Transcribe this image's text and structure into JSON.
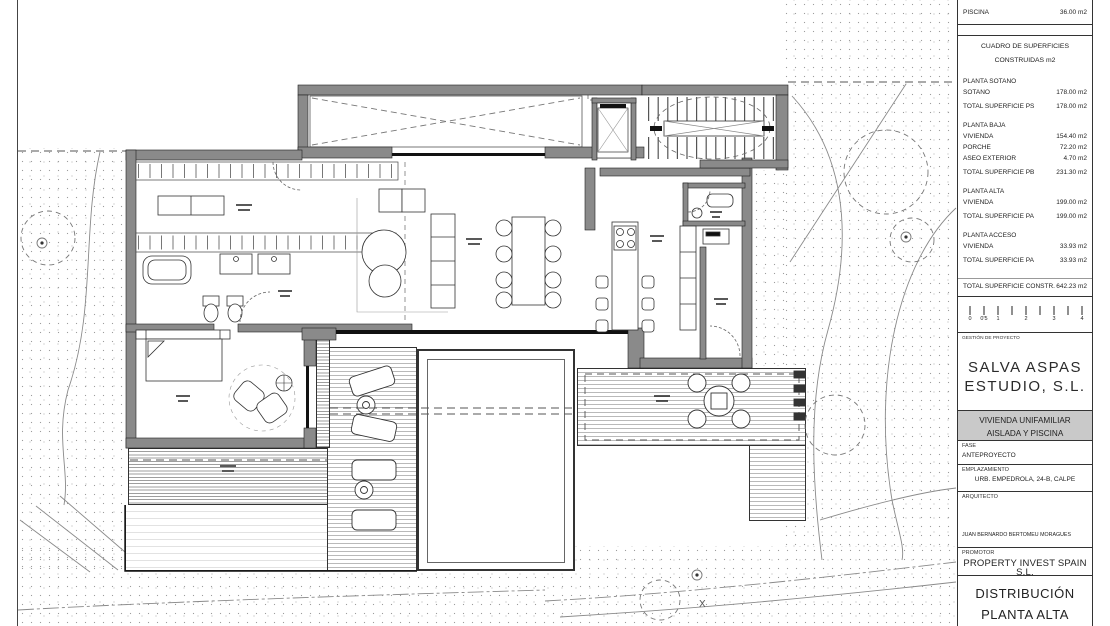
{
  "title_block": {
    "top_row": {
      "label": "PISCINA",
      "value": "36.00 m2"
    },
    "surfaces_table": {
      "title_line1": "CUADRO DE SUPERFICIES",
      "title_line2": "CONSTRUIDAS m2",
      "sections": [
        {
          "heading": "PLANTA SOTANO",
          "rows": [
            {
              "label": "SOTANO",
              "value": "178.00 m2"
            }
          ],
          "total": {
            "label": "TOTAL SUPERFICIE PS",
            "value": "178.00 m2"
          }
        },
        {
          "heading": "PLANTA BAJA",
          "rows": [
            {
              "label": "VIVIENDA",
              "value": "154.40 m2"
            },
            {
              "label": "PORCHE",
              "value": "72.20 m2"
            },
            {
              "label": "ASEO EXTERIOR",
              "value": "4.70 m2"
            }
          ],
          "total": {
            "label": "TOTAL SUPERFICIE PB",
            "value": "231.30 m2"
          }
        },
        {
          "heading": "PLANTA ALTA",
          "rows": [
            {
              "label": "VIVIENDA",
              "value": "199.00 m2"
            }
          ],
          "total": {
            "label": "TOTAL SUPERFICIE PA",
            "value": "199.00 m2"
          }
        },
        {
          "heading": "PLANTA ACCESO",
          "rows": [
            {
              "label": "VIVIENDA",
              "value": "33.93 m2"
            }
          ],
          "total": {
            "label": "TOTAL SUPERFICIE PA",
            "value": "33.93 m2"
          }
        }
      ],
      "grand_total": {
        "label": "TOTAL SUPERFICIE CONSTR.",
        "value": "642.23 m2"
      }
    },
    "scale_bar": {
      "labels": [
        "0",
        "0'5",
        "1",
        "2",
        "3",
        "4"
      ]
    },
    "management": {
      "label": "GESTIÓN DE PROYECTO",
      "name_line1": "SALVA ASPAS",
      "name_line2": "ESTUDIO, S.L."
    },
    "project": {
      "line1": "VIVIENDA UNIFAMILIAR",
      "line2": "AISLADA Y PISCINA"
    },
    "fields": {
      "fase": {
        "label": "FASE",
        "value": "ANTEPROYECTO"
      },
      "emplazamiento": {
        "label": "EMPLAZAMIENTO",
        "value": "URB. EMPEDROLA, 24-B, CALPE"
      },
      "arquitecto": {
        "label": "ARQUITECTO",
        "value": "JUAN BERNARDO BERTOMEU MORAGUES"
      },
      "promotor": {
        "label": "PROMOTOR",
        "value": "PROPERTY INVEST SPAIN S.L."
      }
    },
    "drawing_title": {
      "line1": "DISTRIBUCIÓN",
      "line2": "PLANTA ALTA"
    }
  },
  "plan": {
    "site_marker": "X"
  },
  "colors": {
    "wall": "#8a8a8a",
    "line": "#333333",
    "band_bg": "#c9c9c9"
  }
}
